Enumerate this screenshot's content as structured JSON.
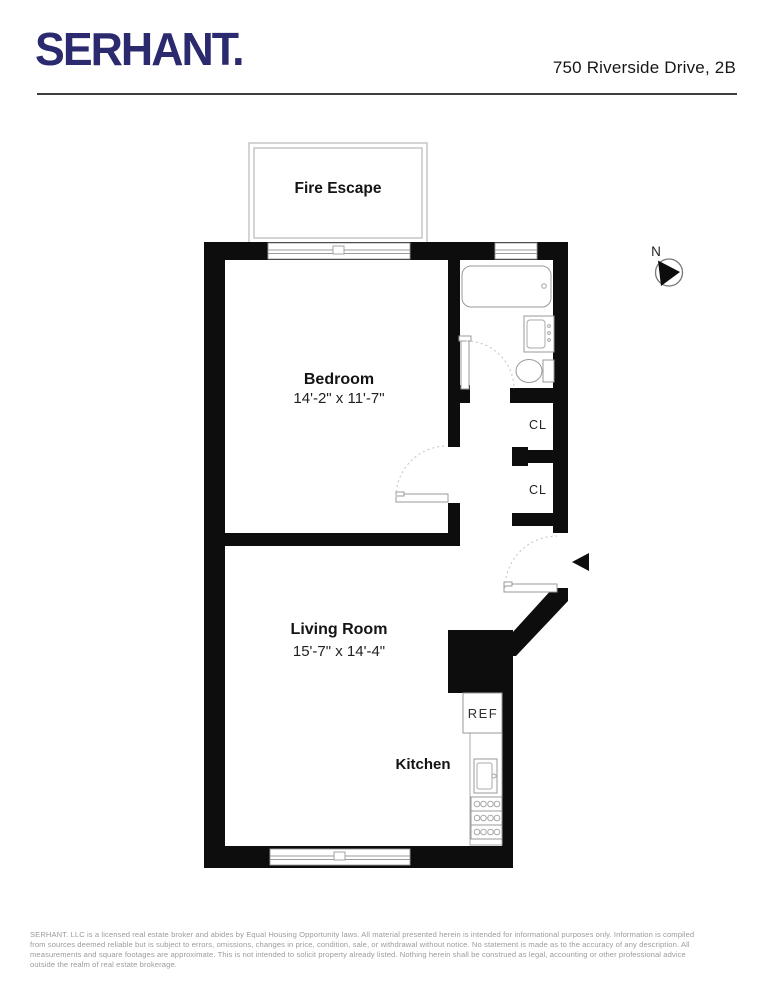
{
  "header": {
    "logo": "SERHANT.",
    "address": "750 Riverside Drive, 2B"
  },
  "floorplan": {
    "fire_escape_label": "Fire Escape",
    "north_label": "N",
    "rooms": {
      "bedroom": {
        "name": "Bedroom",
        "dimensions": "14'-2\" x 11'-7\""
      },
      "living_room": {
        "name": "Living Room",
        "dimensions": "15'-7\" x 14'-4\""
      },
      "kitchen": {
        "name": "Kitchen"
      },
      "closet_upper": {
        "name": "CL"
      },
      "closet_lower": {
        "name": "CL"
      }
    },
    "appliances": {
      "refrigerator": "REF"
    }
  },
  "footer": {
    "lines": [
      "SERHANT. LLC is a licensed real estate broker and abides by Equal Housing Opportunity laws. All material presented herein is intended for informational purposes only. Information is compiled",
      "from sources deemed  reliable but is subject to errors, omissions, changes in price, condition, sale, or withdrawal without notice. No statement is made as to the accuracy of any description. All",
      "measurements and square footages are approximate. This is not intended to solicit property already listed. Nothing herein shall be construed as legal, accounting or other professional advice",
      "outside the realm of real estate brokerage."
    ]
  }
}
